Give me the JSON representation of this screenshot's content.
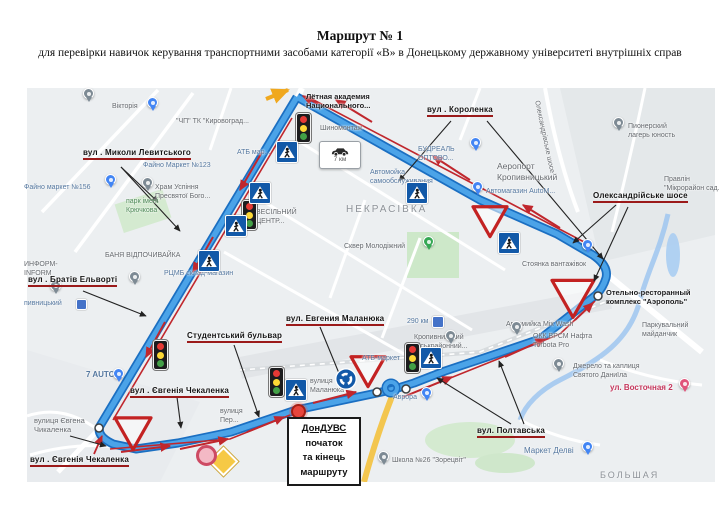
{
  "title": "Маршрут № 1",
  "subtitle": "для перевірки навичок керування транспортними засобами категорії «В» в Донецькому державному університеті внутрішніх справ",
  "colors": {
    "route_blue": "#4ba3e8",
    "route_casing": "#1b6fc2",
    "arrow_red": "#c0272d",
    "annotation_underline": "#9b1a1a",
    "map_bg": "#eceff1",
    "park_green": "#cde8c9",
    "water_blue": "#9fc6f0",
    "sign_blue": "#1259a8",
    "diamond_yellow": "#f6c945"
  },
  "map": {
    "districts": [
      {
        "text": "НЕКРАСІВКА",
        "x": 346,
        "y": 204,
        "s": 10
      },
      {
        "text": "БОЛЬШАЯ",
        "x": 600,
        "y": 470,
        "s": 9
      }
    ],
    "street_annotations": [
      {
        "text": "вул . Миколи Левитського",
        "x": 83,
        "y": 148,
        "arrows": [
          {
            "x1": 121,
            "y1": 167,
            "x2": 158,
            "y2": 202
          },
          {
            "x1": 121,
            "y1": 167,
            "x2": 180,
            "y2": 231
          }
        ]
      },
      {
        "text": "вул . Короленка",
        "x": 427,
        "y": 105,
        "arrows": [
          {
            "x1": 451,
            "y1": 121,
            "x2": 399,
            "y2": 181
          },
          {
            "x1": 487,
            "y1": 121,
            "x2": 603,
            "y2": 259
          }
        ]
      },
      {
        "text": "Олександрійське шосе",
        "x": 593,
        "y": 191,
        "arrows": [
          {
            "x1": 616,
            "y1": 205,
            "x2": 573,
            "y2": 243
          },
          {
            "x1": 628,
            "y1": 207,
            "x2": 594,
            "y2": 281
          }
        ]
      },
      {
        "text": "вул . Братів Ельворті",
        "x": 28,
        "y": 275,
        "arrows": [
          {
            "x1": 83,
            "y1": 291,
            "x2": 146,
            "y2": 316
          }
        ]
      },
      {
        "text": "Студентський бульвар",
        "x": 187,
        "y": 331,
        "arrows": [
          {
            "x1": 234,
            "y1": 345,
            "x2": 259,
            "y2": 417
          }
        ]
      },
      {
        "text": "вул. Евгения Маланюка",
        "x": 286,
        "y": 314,
        "arrows": [
          {
            "x1": 320,
            "y1": 327,
            "x2": 343,
            "y2": 383
          }
        ]
      },
      {
        "text": "вул . Євгенія Чекаленка",
        "x": 130,
        "y": 386,
        "arrows": [
          {
            "x1": 177,
            "y1": 397,
            "x2": 181,
            "y2": 428
          }
        ]
      },
      {
        "text": "вул . Євгенія Чекаленка",
        "x": 30,
        "y": 455,
        "arrows": [
          {
            "x1": 94,
            "y1": 454,
            "x2": 102,
            "y2": 436,
            "c": "red"
          },
          {
            "x1": 70,
            "y1": 436,
            "x2": 106,
            "y2": 446
          }
        ]
      },
      {
        "text": "вул. Полтавська",
        "x": 477,
        "y": 426,
        "arrows": [
          {
            "x1": 511,
            "y1": 424,
            "x2": 437,
            "y2": 378
          },
          {
            "x1": 524,
            "y1": 424,
            "x2": 499,
            "y2": 361
          }
        ]
      }
    ],
    "poi_labels": [
      {
        "lines": [
          "Вікторія"
        ],
        "x": 112,
        "y": 103,
        "c": "g"
      },
      {
        "lines": [
          "\"ЧП\" ТК \"Кировоград..."
        ],
        "x": 176,
        "y": 118,
        "c": "g"
      },
      {
        "lines": [
          "Файно маркет №156"
        ],
        "x": 24,
        "y": 184,
        "c": "b"
      },
      {
        "lines": [
          "Храм Успіння",
          "Пресвятої Бого..."
        ],
        "x": 155,
        "y": 184,
        "c": "g"
      },
      {
        "lines": [
          "парк імені",
          "Крючкова"
        ],
        "x": 126,
        "y": 198,
        "c": "gr"
      },
      {
        "lines": [
          "Файно Маркет №123"
        ],
        "x": 143,
        "y": 162,
        "c": "b"
      },
      {
        "lines": [
          "АТБ мар..."
        ],
        "x": 237,
        "y": 149,
        "c": "b"
      },
      {
        "lines": [
          "Лётная академия",
          "Национального..."
        ],
        "x": 306,
        "y": 92,
        "c": "bk",
        "s": 7.5
      },
      {
        "lines": [
          "Шиномонтаж"
        ],
        "x": 320,
        "y": 125,
        "c": "g"
      },
      {
        "lines": [
          "Автомойка",
          "самообслуживания"
        ],
        "x": 370,
        "y": 169,
        "c": "b"
      },
      {
        "lines": [
          "БУДРЕАЛЬ",
          "ОПТОВО..."
        ],
        "x": 418,
        "y": 146,
        "c": "b"
      },
      {
        "lines": [
          "Аеропорт",
          "Кропивницький"
        ],
        "x": 497,
        "y": 161,
        "c": "g",
        "s": 8.5
      },
      {
        "lines": [
          "Автомагазин AutoM..."
        ],
        "x": 486,
        "y": 188,
        "c": "b"
      },
      {
        "lines": [
          "Пионерский",
          "лагерь юность"
        ],
        "x": 628,
        "y": 123,
        "c": "g"
      },
      {
        "lines": [
          "Правлін",
          "\"Мікрорайон сад..."
        ],
        "x": 664,
        "y": 176,
        "c": "g"
      },
      {
        "lines": [
          "Стоянка вантажівок"
        ],
        "x": 522,
        "y": 261,
        "c": "g"
      },
      {
        "lines": [
          "Отельно-ресторанный",
          "комплекс \"Аэрополь\""
        ],
        "x": 606,
        "y": 288,
        "c": "bk",
        "s": 7.5
      },
      {
        "lines": [
          "Паркувальний",
          "майданчик"
        ],
        "x": 642,
        "y": 322,
        "c": "g"
      },
      {
        "lines": [
          "Автомийка Mix Wash"
        ],
        "x": 506,
        "y": 321,
        "c": "g"
      },
      {
        "lines": [
          "ОКК ВРСМ Нафта",
          "Torbota Pro"
        ],
        "x": 533,
        "y": 333,
        "c": "g"
      },
      {
        "lines": [
          "Джерело та каплиця",
          "Святого Даниїла"
        ],
        "x": 573,
        "y": 363,
        "c": "g"
      },
      {
        "lines": [
          "ул. Восточная 2"
        ],
        "x": 610,
        "y": 383,
        "c": "rd",
        "s": 8
      },
      {
        "lines": [
          "Маркет Делві"
        ],
        "x": 524,
        "y": 446,
        "c": "b",
        "s": 8
      },
      {
        "lines": [
          "Школа №26 \"Зорецвіт\""
        ],
        "x": 392,
        "y": 457,
        "c": "g"
      },
      {
        "lines": [
          "Аврора"
        ],
        "x": 393,
        "y": 394,
        "c": "b"
      },
      {
        "lines": [
          "АТБ-маркет"
        ],
        "x": 362,
        "y": 355,
        "c": "b"
      },
      {
        "lines": [
          "Кропивницький",
          "міськрайонний..."
        ],
        "x": 414,
        "y": 334,
        "c": "g"
      },
      {
        "lines": [
          "290 км"
        ],
        "x": 407,
        "y": 318,
        "c": "b"
      },
      {
        "lines": [
          "7 AUTO"
        ],
        "x": 86,
        "y": 370,
        "c": "b",
        "bold": true,
        "s": 8
      },
      {
        "lines": [
          "вулиця Євгена",
          "Чикаленка"
        ],
        "x": 34,
        "y": 416,
        "c": "g",
        "s": 7.5
      },
      {
        "lines": [
          "вулиця",
          "Маланюка"
        ],
        "x": 310,
        "y": 378,
        "c": "g"
      },
      {
        "lines": [
          "вулиця",
          "Пер..."
        ],
        "x": 220,
        "y": 408,
        "c": "g"
      },
      {
        "lines": [
          "БАНЯ ВІДПОЧИВАЙКА"
        ],
        "x": 105,
        "y": 252,
        "c": "g"
      },
      {
        "lines": [
          "ИНФОРМ-",
          "INFORM"
        ],
        "x": 24,
        "y": 261,
        "c": "g"
      },
      {
        "lines": [
          "пивницький"
        ],
        "x": 24,
        "y": 300,
        "c": "b"
      },
      {
        "lines": [
          "РЦМБ склад-магазин"
        ],
        "x": 164,
        "y": 270,
        "c": "b"
      },
      {
        "lines": [
          "ВЕСІЛЬНИЙ",
          "ЦЕНТР..."
        ],
        "x": 256,
        "y": 209,
        "c": "g"
      },
      {
        "lines": [
          "Сквер Молодіжний"
        ],
        "x": 344,
        "y": 243,
        "c": "g"
      },
      {
        "lines": [
          "Олександрівське шосе"
        ],
        "x": 540,
        "y": 100,
        "c": "g",
        "rot": 78
      }
    ],
    "pins": [
      {
        "x": 152,
        "y": 106,
        "c": "blue"
      },
      {
        "x": 88,
        "y": 97,
        "c": "gray"
      },
      {
        "x": 110,
        "y": 183,
        "c": "blue"
      },
      {
        "x": 147,
        "y": 186,
        "c": "gray"
      },
      {
        "x": 55,
        "y": 289,
        "c": "gray"
      },
      {
        "x": 134,
        "y": 280,
        "c": "gray"
      },
      {
        "x": 475,
        "y": 146,
        "c": "blue"
      },
      {
        "x": 618,
        "y": 126,
        "c": "gray"
      },
      {
        "x": 477,
        "y": 190,
        "c": "blue"
      },
      {
        "x": 587,
        "y": 248,
        "c": "blue"
      },
      {
        "x": 516,
        "y": 330,
        "c": "gray"
      },
      {
        "x": 558,
        "y": 367,
        "c": "gray"
      },
      {
        "x": 684,
        "y": 387,
        "c": "pink"
      },
      {
        "x": 587,
        "y": 450,
        "c": "blue"
      },
      {
        "x": 383,
        "y": 460,
        "c": "gray"
      },
      {
        "x": 426,
        "y": 396,
        "c": "blue"
      },
      {
        "x": 428,
        "y": 245,
        "c": "green"
      },
      {
        "x": 450,
        "y": 339,
        "c": "gray"
      },
      {
        "x": 118,
        "y": 377,
        "c": "blue"
      }
    ],
    "signs": {
      "traffic_lights": [
        {
          "x": 303,
          "y": 127
        },
        {
          "x": 249,
          "y": 214
        },
        {
          "x": 160,
          "y": 354
        },
        {
          "x": 276,
          "y": 381
        },
        {
          "x": 412,
          "y": 357
        }
      ],
      "ped_crossings": [
        {
          "x": 286,
          "y": 151
        },
        {
          "x": 348,
          "y": 153
        },
        {
          "x": 259,
          "y": 192
        },
        {
          "x": 235,
          "y": 225
        },
        {
          "x": 208,
          "y": 260
        },
        {
          "x": 416,
          "y": 192
        },
        {
          "x": 508,
          "y": 242
        },
        {
          "x": 430,
          "y": 357
        },
        {
          "x": 295,
          "y": 389
        }
      ],
      "yield_signs": [
        {
          "x": 490,
          "y": 221,
          "s": 34
        },
        {
          "x": 573,
          "y": 298,
          "s": 42
        },
        {
          "x": 133,
          "y": 433,
          "s": 36
        },
        {
          "x": 368,
          "y": 371,
          "s": 34
        }
      ],
      "roundabout_sign": {
        "x": 346,
        "y": 379
      },
      "priority_diamond": {
        "x": 222,
        "y": 460
      },
      "prohibition_circle": {
        "x": 206,
        "y": 455
      },
      "seven_km_sign": {
        "x": 339,
        "y": 154,
        "label": "7 км"
      },
      "start_marker": {
        "x": 296,
        "y": 409
      },
      "waypoints": [
        {
          "x": 99,
          "y": 428
        },
        {
          "x": 598,
          "y": 296
        },
        {
          "x": 377,
          "y": 392
        },
        {
          "x": 406,
          "y": 389
        }
      ],
      "transit_icons": [
        {
          "x": 80,
          "y": 303,
          "s": 9
        },
        {
          "x": 437,
          "y": 321,
          "s": 10
        }
      ]
    },
    "start_box": {
      "x": 287,
      "y": 417,
      "lines": [
        "ДонДУВС",
        "початок",
        "та кінець",
        "маршруту"
      ],
      "connector": {
        "x1": 304,
        "y1": 417,
        "x2": 298,
        "y2": 412
      }
    }
  }
}
